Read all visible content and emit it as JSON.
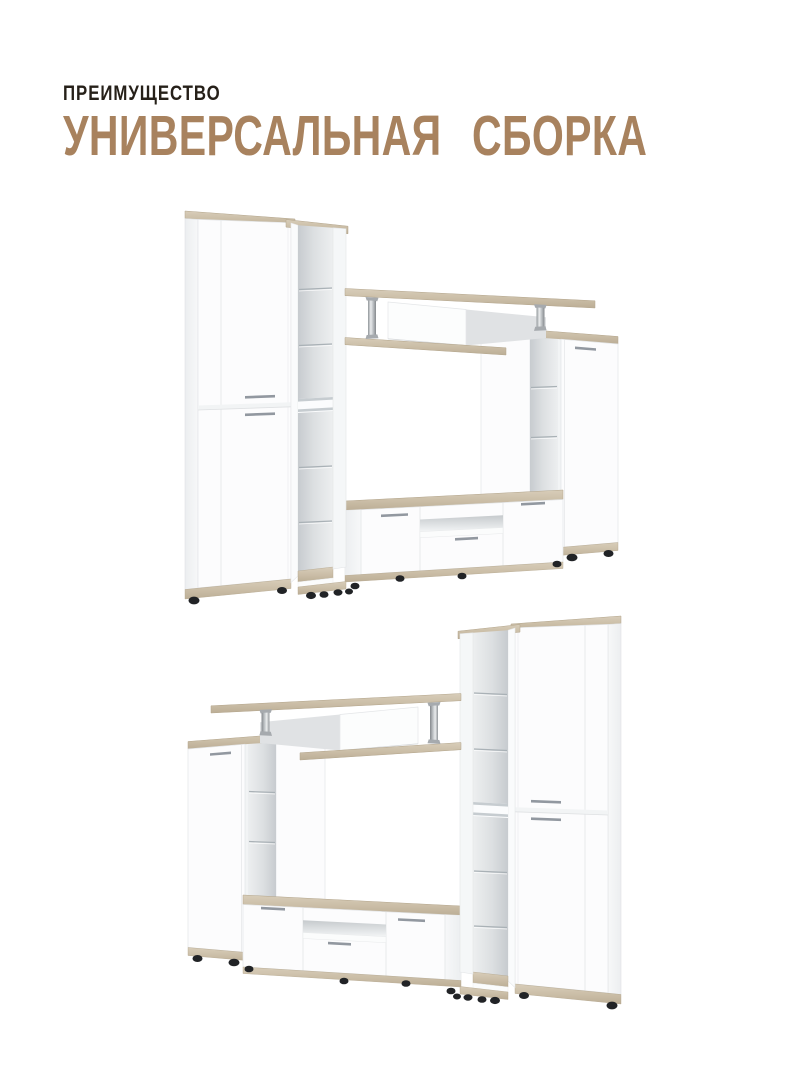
{
  "page": {
    "background": "#ffffff"
  },
  "header": {
    "eyebrow": "ПРЕИМУЩЕСТВО",
    "title": "УНИВЕРСАЛЬНАЯ СБОРКА"
  },
  "figures": [
    {
      "name": "wall-unit-tall-cabinet-left"
    },
    {
      "name": "wall-unit-tall-cabinet-right-mirrored"
    }
  ],
  "palette": {
    "accent_title": "#a8825e",
    "eyebrow_text": "#262019",
    "panel_white": "#fcfcfd",
    "panel_edge": "#e3e5e7",
    "side_shade": "#eef0f2",
    "interior_gray": "#cdd1d5",
    "wood_light": "#d7ccb8",
    "wood_dark": "#bdaf97",
    "chrome": "#c3c7ca",
    "handle_silver": "#9298a0",
    "foot_black": "#212326"
  }
}
